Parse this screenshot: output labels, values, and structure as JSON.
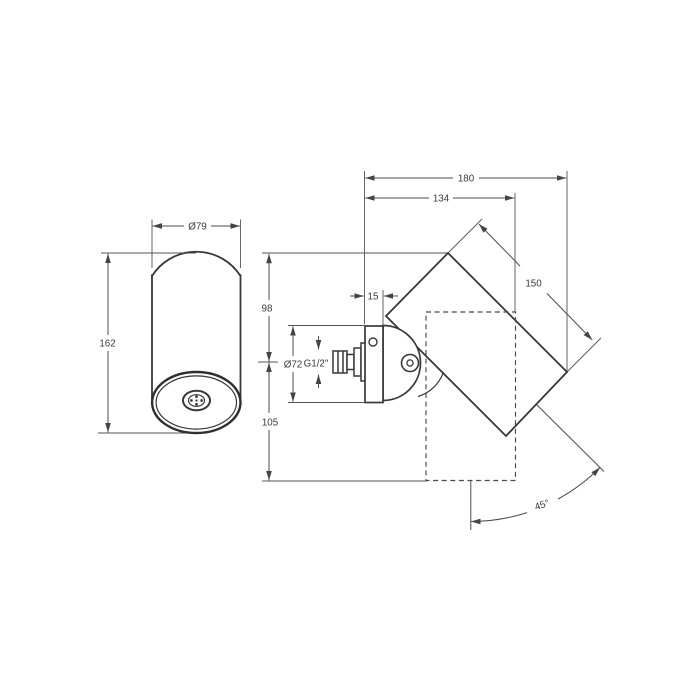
{
  "drawing": {
    "type": "technical-dimension-drawing",
    "background_color": "#ffffff",
    "line_color": "#3d3d3d",
    "front_view": {
      "description": "cylindrical body front view",
      "diameter_label": "Ø79",
      "height_label": "162"
    },
    "side_view": {
      "description": "wall-mounted swivel fixture side view",
      "overall_projection_label": "180",
      "body_projection_label": "134",
      "body_length_label": "150",
      "plate_thickness_label": "15",
      "height_above_axis_label": "98",
      "height_below_axis_label": "105",
      "plate_diameter_label": "Ø72",
      "thread_label": "G1/2\"",
      "swivel_angle_label": "45°"
    }
  }
}
